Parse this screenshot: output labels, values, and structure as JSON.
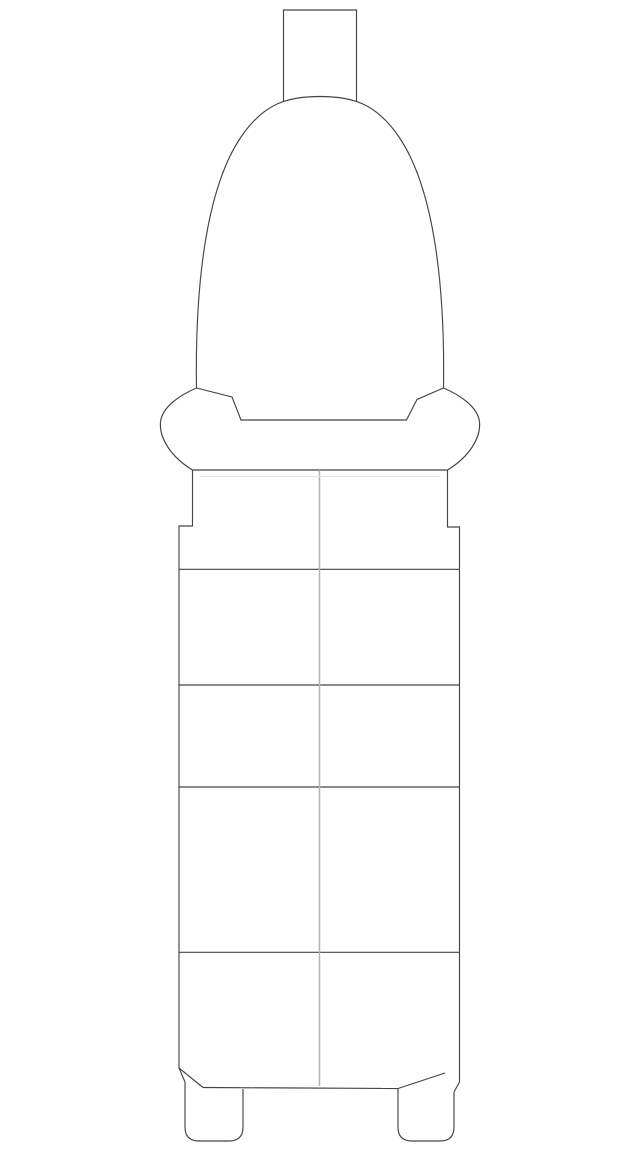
{
  "drawing": {
    "description": "technical line drawing of a part, front view: rectangular terminal tab on top, tall dome-shaped tower, bulged collar flange, segmented rectangular body with center seam, two rounded mounting feet at bottom",
    "background_color": "#ffffff",
    "outline_color": "#454545",
    "center_seam_color": "#b2b2b2",
    "faint_line_color": "#e3e3e3",
    "canvas": {
      "width": 640,
      "height": 1153
    },
    "paths": {
      "terminal_tab": "M 283.5 102 L 283.5 10 L 356.5 10 L 356.5 102",
      "dome_tower": "M 196.5 388 C 195 290 205 190 241 137 C 264 103 288 96.5 320 96.5 C 352 96.5 376 103 399 137 C 435 190 445 290 443.5 388",
      "collar_outer": "M 196.5 388 C 180 395 162 407 160.5 422 C 159 438 171 457 192.5 470 M 443.5 388 C 460 395 478 407 479.5 422 C 481 438 469 457 447.5 470",
      "collar_bottom": "M 192.5 470 L 447.5 470",
      "collar_inner_recess": "M 196.5 388 L 232 397 L 241 420 L 406.5 420 L 417 399.5 L 443.5 388",
      "body_sides": "M 192.5 470 L 192.5 526 L 179 526 L 179 1068 M 447.5 470 L 447.5 527 L 459.5 527 L 459.5 1082",
      "left_foot": "M 179 1068 L 185 1082 L 185 1127 Q 185 1141 199 1141 L 229 1141 Q 243 1141 243 1127 L 243 1089",
      "right_foot": "M 459.5 1082 L 454 1092 L 454 1127 Q 454 1141 440 1141 L 412 1141 Q 398 1141 398 1127 L 398 1088.5",
      "bottom_edge": "M 203 1087.5 L 398 1088.5",
      "left_chamfer_line": "M 179 1068 L 203 1087.5",
      "right_chamfer_line": "M 398 1088.5 L 445 1073",
      "segment_dividers": "M 179 569.3 L 459.5 569.3 M 179 685 L 459.5 685 M 179 787 L 459.5 787 M 179 952.3 L 459.5 952.3",
      "center_seam": "M 319.5 470 L 319.5 1086",
      "faint_seam": "M 200 476.5 L 440 476.5"
    }
  }
}
